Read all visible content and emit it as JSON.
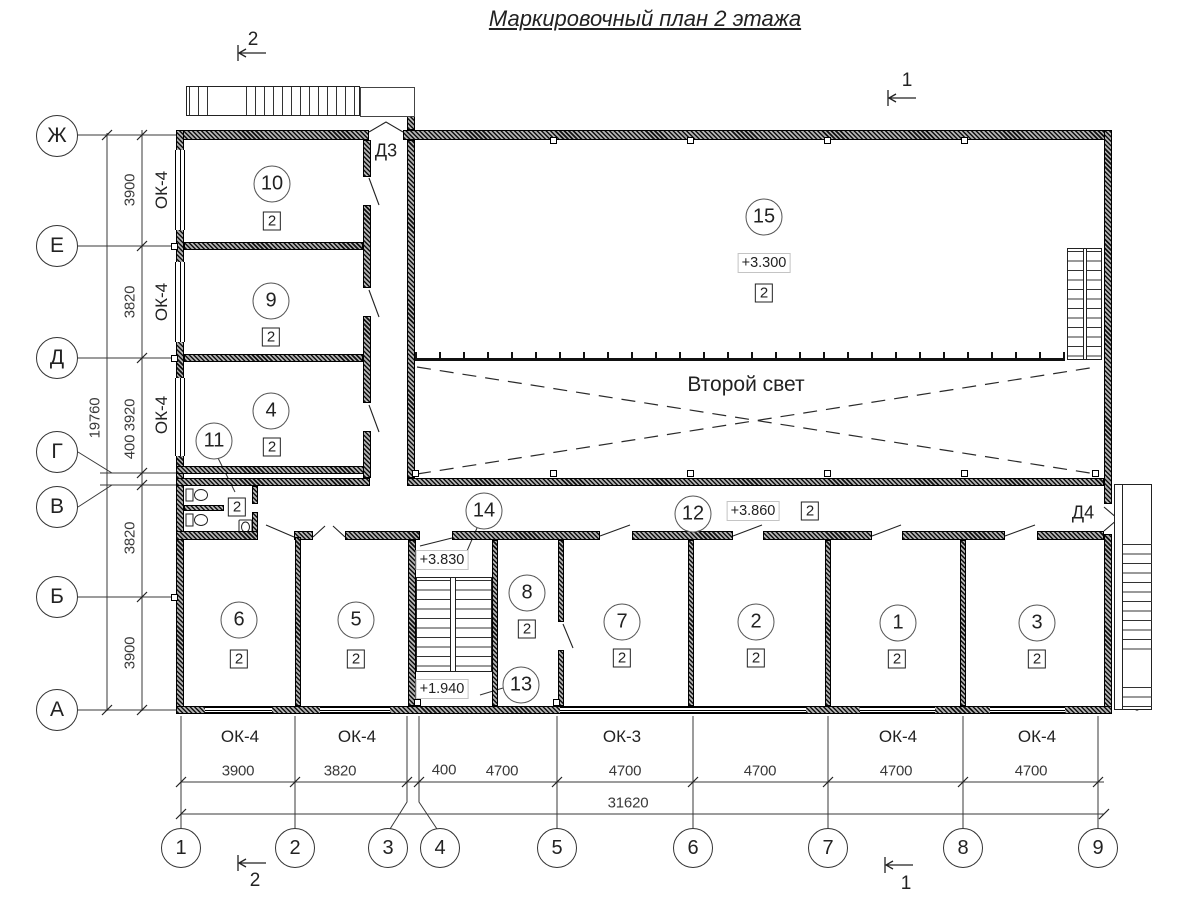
{
  "title": "Маркировочный план 2 этажа",
  "axes_left": [
    "Ж",
    "Е",
    "Д",
    "Г",
    "В",
    "Б",
    "А"
  ],
  "axes_bottom": [
    "1",
    "2",
    "3",
    "4",
    "5",
    "6",
    "7",
    "8",
    "9"
  ],
  "dims_left": {
    "chain": [
      "3900",
      "3820",
      "3920",
      "400",
      "3820",
      "3900"
    ],
    "total": "19760"
  },
  "dims_bottom": {
    "chain": [
      "3900",
      "3820",
      "400",
      "4700",
      "4700",
      "4700",
      "4700",
      "4700"
    ],
    "total": "31620"
  },
  "rooms": [
    {
      "number": "10",
      "type": "2"
    },
    {
      "number": "9",
      "type": "2"
    },
    {
      "number": "4",
      "type": "2"
    },
    {
      "number": "11",
      "type": "2"
    },
    {
      "number": "15",
      "type": "2",
      "elevation": "+3.300"
    },
    {
      "number": "14",
      "elevation": "+3.830"
    },
    {
      "number": "8",
      "type": "2"
    },
    {
      "number": "13",
      "elevation": "+1.940"
    },
    {
      "number": "12",
      "type": "2",
      "elevation": "+3.860"
    },
    {
      "number": "6",
      "type": "2"
    },
    {
      "number": "5",
      "type": "2"
    },
    {
      "number": "7",
      "type": "2"
    },
    {
      "number": "2",
      "type": "2"
    },
    {
      "number": "1",
      "type": "2"
    },
    {
      "number": "3",
      "type": "2"
    }
  ],
  "doors": {
    "d3": "Д3",
    "d4": "Д4"
  },
  "windows_left": [
    "ОК-4",
    "ОК-4",
    "ОК-4"
  ],
  "windows_bottom": [
    "ОК-4",
    "ОК-4",
    "ОК-3",
    "ОК-4",
    "ОК-4"
  ],
  "annotations": {
    "second_light": "Второй свет"
  },
  "sections": {
    "s1": "1",
    "s2": "2"
  },
  "colors": {
    "line": "#2a2a2a",
    "wall": "#111"
  }
}
